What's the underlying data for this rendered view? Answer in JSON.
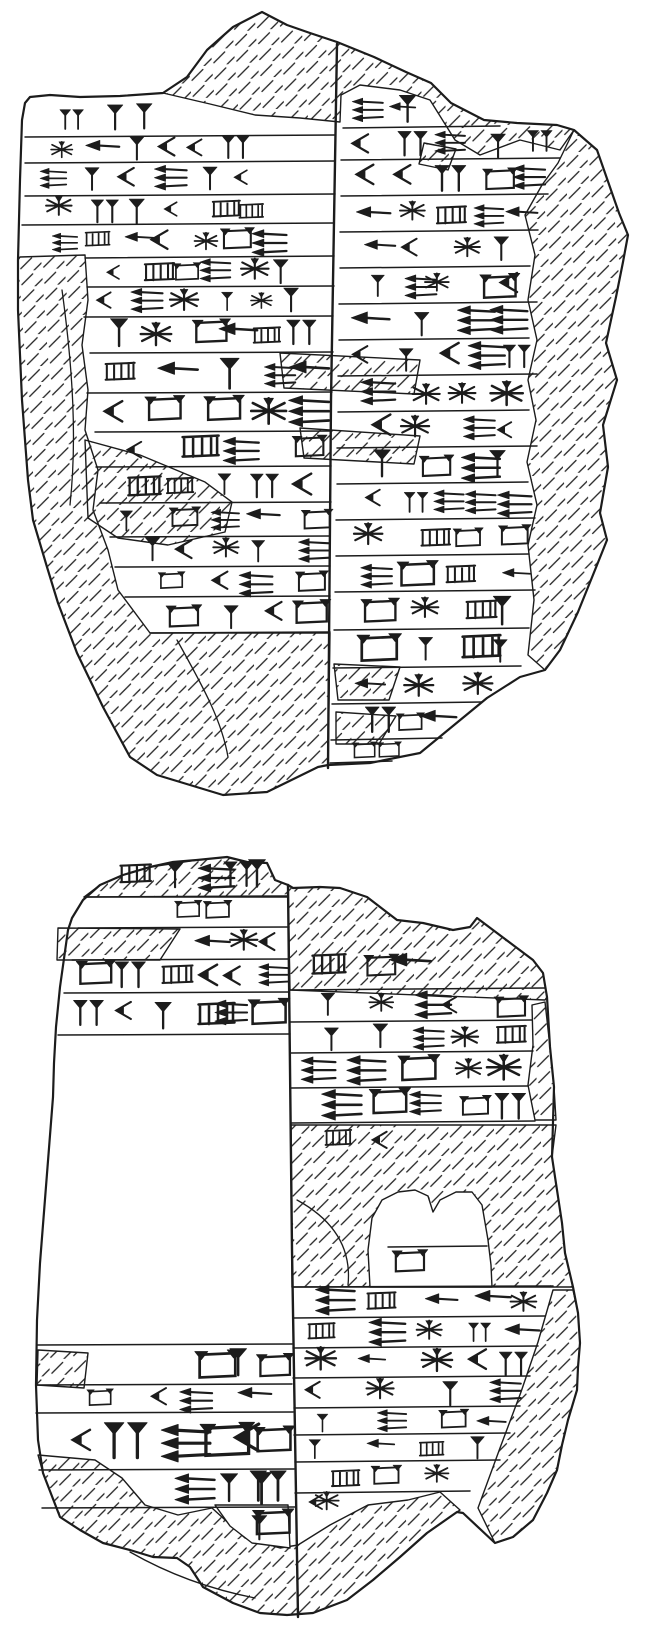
{
  "canvas": {
    "viewbox": "0 0 664 1638",
    "width": 664,
    "height": 1638,
    "background": "#ffffff",
    "ink": "#1c1c1c"
  },
  "glyph_ids": [
    "hw",
    "vw",
    "wk",
    "lad",
    "st",
    "dv",
    "hh",
    "bx"
  ],
  "tablets": [
    {
      "name": "tablet-fragment-1",
      "outline": "M25,103 L30,97 L50,95 L80,97 L120,96 L163,93 L187,77 L207,50 L233,27 L262,12 L287,25 L310,33 L337,42 L374,57 L406,72 L431,83 L451,103 L484,120 L517,123 L557,125 L574,130 L597,150 L619,213 L628,235 L623,262 L616,297 L606,343 L617,380 L603,425 L608,467 L600,513 L607,540 L597,565 L578,612 L560,650 L545,670 L520,677 L487,698 L420,753 L370,763 L328,765 L318,767 L267,792 L223,795 L157,775 L130,757 L103,707 L77,653 L58,603 L47,567 L33,520 L28,480 L22,400 L18,310 L18,260 L20,180 L22,120 Z",
      "divider": "M337,44 L331,400 L328,768",
      "hatches": [
        "M163,93 L187,77 L207,50 L233,27 L262,12 L287,25 L310,33 L337,42 L374,57 L406,72 L431,83 L451,103 L484,120 L517,123 L557,125 L574,130 L560,150 L520,140 L480,155 L455,140 L430,100 L400,90 L360,85 L341,95 L340,122 L300,118 L255,115 L210,104 Z",
        "M574,130 L597,150 L619,213 L628,235 L623,262 L616,297 L606,343 L617,380 L603,425 L608,467 L600,513 L607,540 L597,565 L578,612 L560,650 L545,670 L528,655 L534,600 L528,545 L537,505 L527,462 L536,420 L528,380 L537,340 L528,300 L535,255 L525,215 L542,185 L558,163 Z",
        "M20,257 L85,255 L88,300 L82,345 L88,390 L85,430 L98,470 L93,510 L108,550 L118,590 L150,633 L330,633 L328,765 L318,767 L267,792 L223,795 L157,775 L130,757 L103,707 L77,653 L58,603 L47,567 L33,520 L28,480 L22,400 L18,310 L18,260 Z",
        "M85,440 L140,455 L205,482 L232,502 L225,532 L168,545 L118,538 L88,518 Z",
        "M280,353 L420,360 L414,394 L284,388 Z",
        "M300,428 L420,436 L414,464 L304,458 Z",
        "M334,664 L400,667 L389,700 L338,700 Z",
        "M336,712 L396,716 L379,744 L336,744 Z",
        "M424,143 L456,149 L448,170 L419,164 Z"
      ],
      "white_patches": [],
      "contours": [
        "M177,640 C205,690 222,722 228,757",
        "M62,290 C73,370 77,440 70,505"
      ],
      "rulings": [
        [
          25,
          137,
          335,
          135
        ],
        [
          25,
          163,
          335,
          161
        ],
        [
          25,
          196,
          335,
          194
        ],
        [
          22,
          225,
          334,
          223
        ],
        [
          85,
          258,
          334,
          256
        ],
        [
          87,
          287,
          334,
          286
        ],
        [
          84,
          317,
          333,
          316
        ],
        [
          90,
          353,
          333,
          352
        ],
        [
          87,
          393,
          332,
          392
        ],
        [
          95,
          432,
          332,
          431
        ],
        [
          96,
          467,
          331,
          466
        ],
        [
          100,
          503,
          331,
          502
        ],
        [
          110,
          537,
          330,
          536
        ],
        [
          115,
          567,
          330,
          566
        ],
        [
          125,
          597,
          330,
          596
        ],
        [
          150,
          633,
          330,
          632
        ],
        [
          343,
          128,
          500,
          126
        ],
        [
          341,
          160,
          560,
          158
        ],
        [
          341,
          196,
          548,
          194
        ],
        [
          340,
          232,
          538,
          230
        ],
        [
          340,
          268,
          530,
          266
        ],
        [
          339,
          304,
          537,
          302
        ],
        [
          339,
          340,
          529,
          338
        ],
        [
          338,
          376,
          537,
          374
        ],
        [
          338,
          412,
          529,
          410
        ],
        [
          337,
          448,
          537,
          446
        ],
        [
          337,
          484,
          528,
          482
        ],
        [
          336,
          520,
          535,
          518
        ],
        [
          336,
          556,
          529,
          554
        ],
        [
          335,
          592,
          535,
          590
        ],
        [
          334,
          630,
          529,
          628
        ],
        [
          333,
          668,
          521,
          666
        ],
        [
          332,
          704,
          482,
          702
        ],
        [
          331,
          740,
          442,
          738
        ],
        [
          330,
          763,
          392,
          761
        ]
      ],
      "sign_rows": [
        [
          118,
          55,
          165,
          3,
          30
        ],
        [
          150,
          30,
          255,
          6,
          26
        ],
        [
          180,
          30,
          260,
          6,
          26
        ],
        [
          210,
          30,
          270,
          6,
          26
        ],
        [
          242,
          30,
          285,
          7,
          27
        ],
        [
          272,
          90,
          300,
          6,
          26
        ],
        [
          302,
          90,
          312,
          6,
          26
        ],
        [
          335,
          92,
          320,
          6,
          30
        ],
        [
          373,
          95,
          328,
          5,
          32
        ],
        [
          412,
          92,
          328,
          5,
          32
        ],
        [
          450,
          100,
          328,
          4,
          30
        ],
        [
          485,
          100,
          328,
          5,
          30
        ],
        [
          520,
          112,
          328,
          5,
          28
        ],
        [
          552,
          118,
          328,
          5,
          26
        ],
        [
          582,
          128,
          328,
          4,
          26
        ],
        [
          615,
          152,
          328,
          4,
          28
        ],
        [
          108,
          345,
          430,
          3,
          28
        ],
        [
          144,
          345,
          555,
          5,
          28
        ],
        [
          178,
          345,
          545,
          5,
          30
        ],
        [
          214,
          345,
          535,
          5,
          30
        ],
        [
          250,
          345,
          527,
          4,
          30
        ],
        [
          286,
          345,
          532,
          5,
          30
        ],
        [
          322,
          345,
          526,
          4,
          30
        ],
        [
          358,
          345,
          532,
          5,
          30
        ],
        [
          394,
          345,
          526,
          4,
          30
        ],
        [
          430,
          345,
          532,
          4,
          30
        ],
        [
          466,
          345,
          525,
          4,
          30
        ],
        [
          502,
          345,
          530,
          5,
          30
        ],
        [
          538,
          345,
          526,
          4,
          30
        ],
        [
          574,
          345,
          530,
          4,
          30
        ],
        [
          611,
          345,
          526,
          4,
          32
        ],
        [
          649,
          345,
          518,
          4,
          32
        ],
        [
          686,
          345,
          495,
          3,
          30
        ],
        [
          722,
          345,
          455,
          3,
          28
        ],
        [
          751,
          342,
          405,
          2,
          22
        ]
      ]
    },
    {
      "name": "tablet-fragment-2",
      "outline": "M83,900 L100,885 L123,875 L150,867 L173,862 L197,860 L227,857 L247,862 L267,863 L275,880 L288,885 L293,888 L320,887 L340,888 L367,897 L397,920 L423,923 L453,930 L470,927 L477,918 L493,930 L513,945 L533,960 L543,973 L547,997 L550,1047 L554,1087 L552,1157 L557,1190 L562,1223 L565,1253 L573,1287 L578,1313 L580,1343 L578,1367 L577,1390 L568,1420 L562,1445 L557,1470 L547,1493 L533,1520 L513,1537 L495,1543 L463,1513 L457,1512 L427,1533 L400,1557 L373,1580 L347,1600 L313,1613 L287,1615 L260,1613 L233,1603 L203,1587 L190,1567 L177,1558 L153,1557 L130,1550 L103,1543 L80,1530 L60,1517 L43,1473 L38,1440 L36,1385 L37,1320 L40,1263 L53,1097 L54,1063 L56,1027 L60,987 L68,930 L72,918 Z",
      "divider": "M288,885 L292,1250 L298,1617",
      "hatches": [
        "M84,897 L100,885 L123,875 L150,867 L197,860 L227,857 L247,862 L267,863 L275,880 L288,885 L288,897 Z",
        "M58,928 L180,929 L160,960 L57,960 Z",
        "M288,885 L293,888 L320,887 L340,888 L367,897 L397,920 L423,923 L453,930 L470,927 L477,918 L493,930 L513,945 L533,960 L543,973 L547,997 L545,1000 L290,990 Z",
        "M532,1005 L545,1002 L550,1047 L554,1087 L556,1120 L535,1120 L528,1085 L533,1045 Z",
        "M291,1125 L556,1125 L552,1157 L557,1190 L562,1223 L565,1253 L573,1287 L292,1287 Z",
        "M553,1290 L573,1290 L578,1313 L580,1343 L578,1367 L577,1390 L568,1420 L562,1445 L557,1470 L547,1493 L533,1520 L513,1537 L495,1543 L478,1508 L500,1448 L521,1392 L538,1342 Z",
        "M38,1455 L95,1460 L122,1478 L145,1505 L178,1515 L212,1508 L245,1538 L280,1548 L298,1545 L330,1525 L368,1505 L408,1500 L440,1492 L460,1510 L427,1533 L400,1557 L373,1580 L347,1600 L313,1613 L287,1615 L260,1613 L233,1603 L203,1587 L190,1567 L177,1558 L153,1557 L130,1550 L103,1543 L80,1530 L60,1517 L43,1473 Z",
        "M38,1350 L88,1353 L84,1388 L37,1385 Z"
      ],
      "white_patches": [
        "M370,1287 L368,1250 L372,1218 L382,1200 L398,1192 L415,1190 L428,1196 L433,1212 L440,1200 L456,1192 L472,1192 L482,1205 L488,1240 L491,1265 L492,1287 Z",
        "M215,1505 L288,1505 L290,1548 L252,1543 L230,1526 Z"
      ],
      "contours": [
        "M297,1200 C330,1218 352,1245 348,1285",
        "M130,1552 C172,1576 214,1590 255,1598"
      ],
      "rulings": [
        [
          84,
          897,
          288,
          896
        ],
        [
          78,
          928,
          289,
          927
        ],
        [
          72,
          960,
          289,
          959
        ],
        [
          64,
          993,
          289,
          992
        ],
        [
          58,
          1035,
          290,
          1034
        ],
        [
          37,
          1345,
          292,
          1344
        ],
        [
          36,
          1385,
          292,
          1384
        ],
        [
          36,
          1413,
          293,
          1412
        ],
        [
          39,
          1470,
          294,
          1469
        ],
        [
          42,
          1508,
          295,
          1507
        ],
        [
          290,
          990,
          545,
          988
        ],
        [
          290,
          1022,
          532,
          1020
        ],
        [
          291,
          1053,
          533,
          1051
        ],
        [
          291,
          1088,
          528,
          1086
        ],
        [
          291,
          1123,
          535,
          1121
        ],
        [
          292,
          1287,
          553,
          1286
        ],
        [
          293,
          1318,
          545,
          1316
        ],
        [
          293,
          1348,
          538,
          1346
        ],
        [
          293,
          1378,
          530,
          1376
        ],
        [
          294,
          1408,
          520,
          1406
        ],
        [
          294,
          1435,
          510,
          1433
        ],
        [
          295,
          1462,
          500,
          1460
        ],
        [
          295,
          1493,
          470,
          1491
        ],
        [
          388,
          1247,
          487,
          1246
        ]
      ],
      "sign_rows": [
        [
          876,
          110,
          280,
          5,
          30
        ],
        [
          912,
          163,
          228,
          2,
          28
        ],
        [
          944,
          185,
          286,
          3,
          28
        ],
        [
          976,
          66,
          286,
          6,
          30
        ],
        [
          1014,
          60,
          286,
          6,
          34
        ],
        [
          1365,
          178,
          290,
          3,
          34
        ],
        [
          1399,
          55,
          286,
          4,
          26
        ],
        [
          1441,
          60,
          291,
          6,
          40
        ],
        [
          1488,
          165,
          292,
          4,
          34
        ],
        [
          1526,
          228,
          290,
          2,
          34
        ],
        [
          965,
          298,
          430,
          3,
          34
        ],
        [
          1006,
          295,
          525,
          5,
          30
        ],
        [
          1038,
          295,
          528,
          5,
          30
        ],
        [
          1070,
          295,
          524,
          5,
          32
        ],
        [
          1105,
          295,
          530,
          5,
          32
        ],
        [
          1140,
          295,
          420,
          2,
          30
        ],
        [
          1302,
          296,
          546,
          5,
          30
        ],
        [
          1333,
          296,
          538,
          5,
          28
        ],
        [
          1363,
          296,
          531,
          5,
          28
        ],
        [
          1393,
          296,
          523,
          4,
          28
        ],
        [
          1422,
          297,
          513,
          4,
          26
        ],
        [
          1449,
          297,
          503,
          4,
          26
        ],
        [
          1477,
          297,
          478,
          3,
          26
        ],
        [
          1505,
          300,
          340,
          2,
          26
        ],
        [
          1262,
          382,
          428,
          1,
          30
        ]
      ]
    }
  ]
}
